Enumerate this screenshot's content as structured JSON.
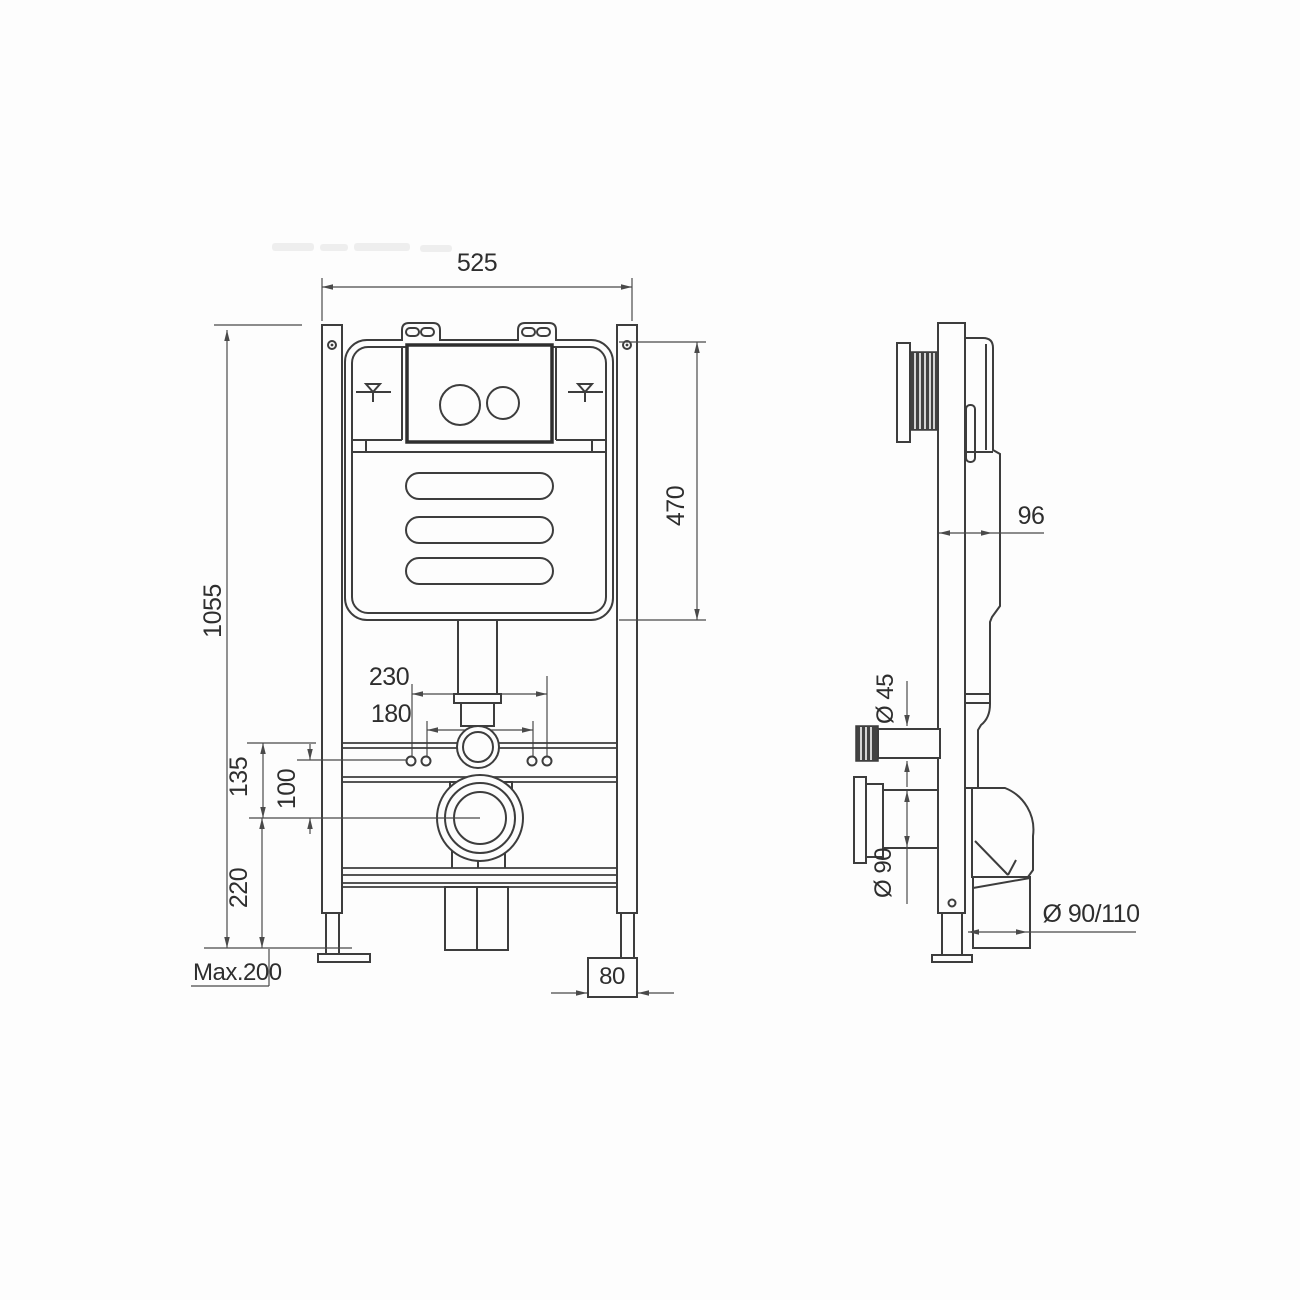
{
  "drawing": {
    "background": "#fdfdfd",
    "stroke_color": "#3d3d3d",
    "dimension_color": "#4a4a4a",
    "views": {
      "front": {
        "name": "front-view",
        "dims": {
          "frame_width": "525",
          "frame_height": "1055",
          "cistern_height": "470",
          "fixing_spacing_outer": "230",
          "fixing_spacing_inner": "180",
          "rail_to_outlet_center": "135",
          "fixings_to_outlet_center": "100",
          "outlet_center_to_floor": "220",
          "foot_adjustment": "Max.200",
          "foot_width": "80"
        }
      },
      "side": {
        "name": "side-view",
        "dims": {
          "frame_depth": "96",
          "inlet_diameter": "Ø 45",
          "outlet_diameter": "Ø 90",
          "waste_diameter": "Ø 90/110"
        }
      }
    }
  }
}
